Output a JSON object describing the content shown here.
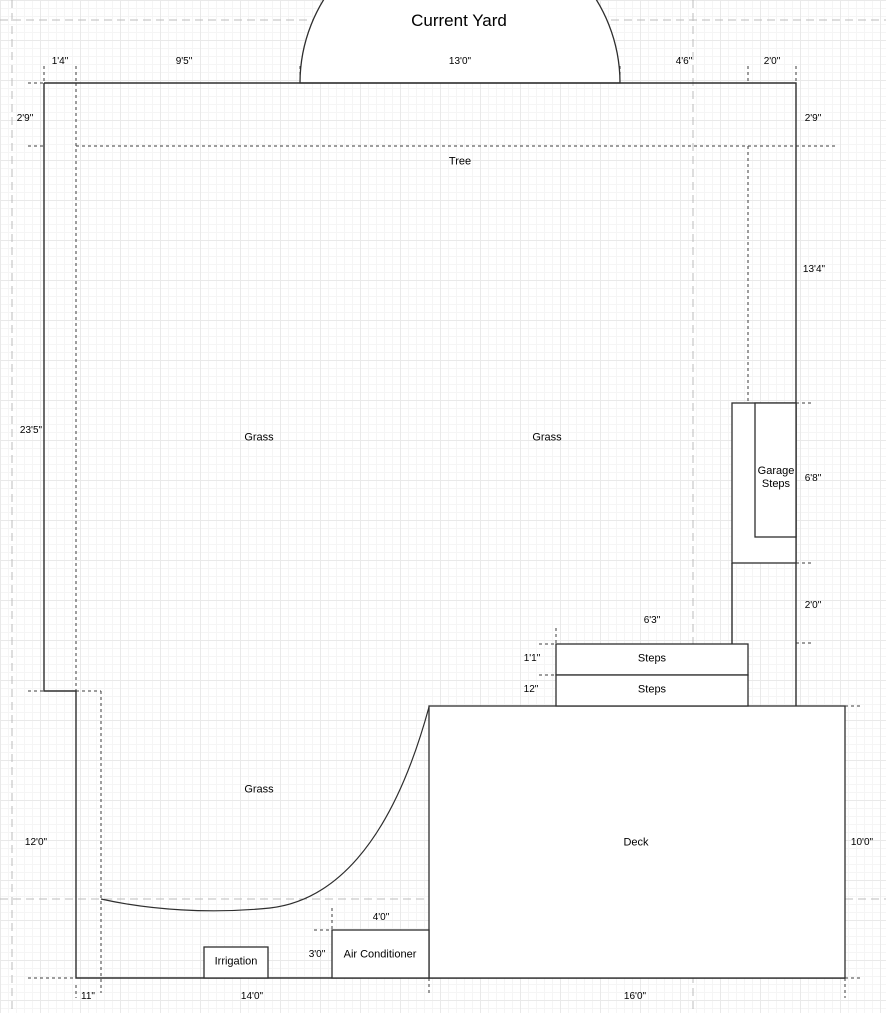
{
  "title": "Current Yard",
  "labels": {
    "tree": "Tree",
    "grass_left": "Grass",
    "grass_right": "Grass",
    "grass_bottom": "Grass",
    "deck": "Deck",
    "steps_upper": "Steps",
    "steps_lower": "Steps",
    "garage_steps": "Garage Steps",
    "air_conditioner": "Air Conditioner",
    "irrigation": "Irrigation"
  },
  "dimensions": {
    "top": [
      "1'4\"",
      "9'5\"",
      "13'0\"",
      "4'6\"",
      "2'0\""
    ],
    "left": [
      "2'9\"",
      "23'5\"",
      "12'0\""
    ],
    "right": [
      "2'9\"",
      "13'4\"",
      "6'8\"",
      "2'0\"",
      "10'0\""
    ],
    "bottom": [
      "11\"",
      "14'0\"",
      "16'0\""
    ],
    "steps": [
      "6'3\"",
      "1'1\"",
      "12\""
    ],
    "air_conditioner": [
      "4'0\"",
      "3'0\""
    ]
  },
  "colors": {
    "line": "#2e2e2e",
    "guide": "#3d3d3d",
    "page_boundary": "#bcbcbc",
    "grid_major": "#e9e9e9",
    "grid_minor": "#f5f5f5",
    "fill": "#ffffff"
  }
}
